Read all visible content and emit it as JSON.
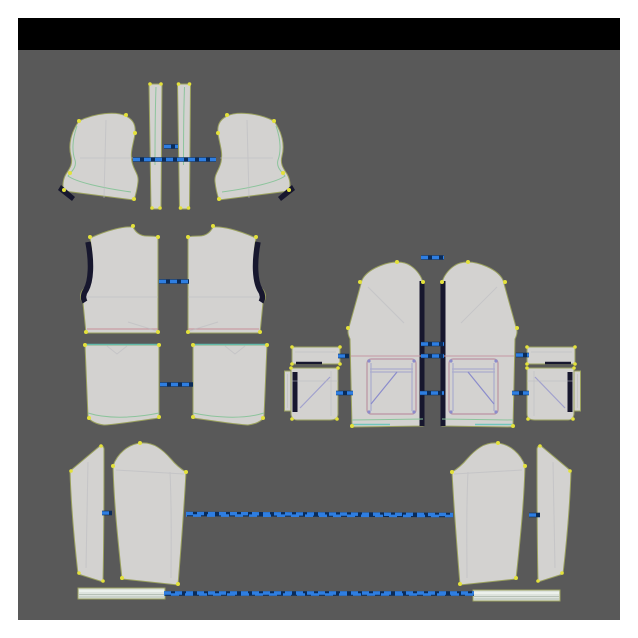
{
  "window": {
    "description": "2D garment pattern editing canvas with sewn-seam connection lines",
    "visible_text": ""
  },
  "colors": {
    "margin": "#ffffff",
    "titlebar": "#000000",
    "workspace": "#595959",
    "piece-fill": "#d3d2d0",
    "piece-stroke": "#9aa15e",
    "navy": "#17172e",
    "seam-blue": "#2e7ee2",
    "seam-under": "#0a2c5a",
    "dot-yellow": "#e3e13b",
    "line-green": "#8cc49c",
    "line-teal": "#5fc4b8",
    "line-pink": "#c498a4",
    "line-red": "#c47e8a",
    "line-purple": "#8b8ccc",
    "line-faint": "#b9b9bf",
    "cuff-fill": "#dde3dd",
    "cuff-hi": "#f2f6f1",
    "cuff-line": "#b7c1b7",
    "pocket-stroke": "#bb93a2"
  },
  "pieces": [
    {
      "id": "hood-side-left",
      "label": "Hood side panel (left)"
    },
    {
      "id": "hood-center-strip-1",
      "label": "Hood center strip 1"
    },
    {
      "id": "hood-center-strip-2",
      "label": "Hood center strip 2"
    },
    {
      "id": "hood-side-right",
      "label": "Hood side panel (right)"
    },
    {
      "id": "back-upper-left",
      "label": "Back upper bodice (left half)"
    },
    {
      "id": "back-upper-right",
      "label": "Back upper bodice (right half)"
    },
    {
      "id": "back-lower-left",
      "label": "Back lower panel (left half)"
    },
    {
      "id": "back-lower-right",
      "label": "Back lower panel (right half)"
    },
    {
      "id": "front-panel-left",
      "label": "Front panel with pocket (left)"
    },
    {
      "id": "front-panel-right",
      "label": "Front panel with pocket (right)"
    },
    {
      "id": "pocket-flap-left",
      "label": "Pocket flap (left)"
    },
    {
      "id": "pocket-flap-right",
      "label": "Pocket flap (right)"
    },
    {
      "id": "pocket-bag-left",
      "label": "Pocket bag (left)"
    },
    {
      "id": "pocket-side-strip-left",
      "label": "Pocket side strip (left)"
    },
    {
      "id": "pocket-bag-right",
      "label": "Pocket bag (right)"
    },
    {
      "id": "pocket-side-strip-right",
      "label": "Pocket side strip (right)"
    },
    {
      "id": "sleeve-under-left",
      "label": "Under sleeve (left)"
    },
    {
      "id": "sleeve-main-left",
      "label": "Main sleeve (left)"
    },
    {
      "id": "sleeve-main-right",
      "label": "Main sleeve (right)"
    },
    {
      "id": "sleeve-under-right",
      "label": "Under sleeve (right)"
    },
    {
      "id": "cuff-left",
      "label": "Sleeve cuff band (left)"
    },
    {
      "id": "cuff-right",
      "label": "Sleeve cuff band (right)"
    }
  ],
  "connectors": {
    "style": "blue dashed sewing relation lines",
    "count": 16
  }
}
